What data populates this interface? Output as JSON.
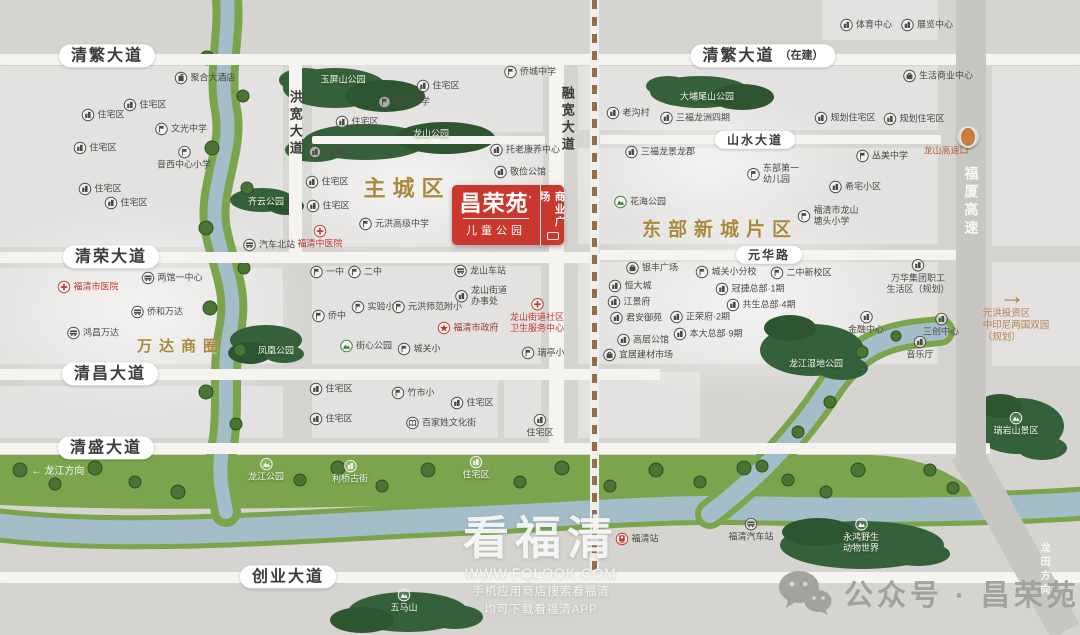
{
  "palette": {
    "bg": "#d5d4d1",
    "road": "#f5f4f1",
    "highway": "#c7c6c3",
    "water": "#a3bdc9",
    "bank": "#7ba44c",
    "park_dark": "#33603a",
    "gold": "#a8893e",
    "red": "#bf3a33",
    "logo_red": "#c9372f",
    "text": "#4b4a47",
    "brown": "#b5804e"
  },
  "logo": {
    "name": "昌荣苑",
    "mark": "’",
    "sub": "儿童公园",
    "side": "商业广场"
  },
  "watermark": {
    "title": "看福清",
    "url": "WWW.FQLOOK.COM",
    "line1": "手机应用商店搜索看福清",
    "line2": "均可下载看福清APP"
  },
  "wechat": {
    "text": "公众号 · 昌荣苑"
  },
  "map": {
    "blocks": [
      [
        0,
        66,
        283,
        181
      ],
      [
        0,
        268,
        283,
        96
      ],
      [
        0,
        386,
        283,
        52
      ],
      [
        312,
        62,
        231,
        70
      ],
      [
        312,
        144,
        231,
        103
      ],
      [
        312,
        266,
        229,
        98
      ],
      [
        312,
        374,
        186,
        64
      ],
      [
        504,
        374,
        37,
        64
      ],
      [
        578,
        66,
        360,
        64
      ],
      [
        578,
        148,
        360,
        96
      ],
      [
        578,
        262,
        360,
        102
      ],
      [
        578,
        372,
        122,
        66
      ],
      [
        822,
        0,
        116,
        40
      ],
      [
        992,
        66,
        88,
        180
      ],
      [
        992,
        262,
        88,
        104
      ]
    ],
    "glows": [
      [
        140,
        310,
        360,
        220
      ],
      [
        410,
        185,
        300,
        160
      ],
      [
        750,
        300,
        360,
        210
      ],
      [
        710,
        165,
        300,
        150
      ]
    ],
    "roads_h": [
      [
        0,
        54,
        1080,
        11
      ],
      [
        600,
        135,
        341,
        9
      ],
      [
        312,
        136,
        233,
        8
      ],
      [
        0,
        252,
        600,
        11
      ],
      [
        600,
        250,
        356,
        10
      ],
      [
        0,
        369,
        660,
        11
      ],
      [
        0,
        443,
        990,
        11
      ],
      [
        0,
        572,
        1080,
        11
      ]
    ],
    "roads_v": [
      [
        289,
        54,
        13,
        209
      ],
      [
        549,
        54,
        15,
        400
      ]
    ],
    "highway": {
      "v": [
        956,
        0,
        30,
        470
      ],
      "slant": {
        "x": 950,
        "y": 452,
        "w": 32,
        "h": 205,
        "rot": -29
      }
    },
    "dash": {
      "x": 590,
      "y": 0,
      "h": 575
    },
    "rivers": {
      "belt": "M0,455 L870,455 C908,456 938,466 962,482 L976,494 C930,503 880,501 820,498 C680,491 560,501 420,505 C280,509 130,511 0,505 Z",
      "left": "M226,-10 C232,30 218,70 226,110 C234,150 208,190 216,230 C224,270 238,290 230,330 C222,370 230,410 222,450 C218,475 222,490 226,512",
      "bottom": "M-12,524 C120,542 300,526 460,519 C580,514 650,507 735,508 C840,510 960,512 1092,503",
      "branch": "M710,514 C765,472 800,432 828,390 C850,357 872,341 906,335 C922,332 932,332 940,331"
    },
    "parks": [
      {
        "name": "yuping-park",
        "shapes": [
          [
            335,
            88,
            52,
            20
          ],
          [
            385,
            96,
            40,
            16
          ],
          [
            305,
            80,
            26,
            12
          ]
        ]
      },
      {
        "name": "longshan-park",
        "shapes": [
          [
            365,
            142,
            62,
            18
          ],
          [
            445,
            138,
            50,
            16
          ],
          [
            315,
            150,
            30,
            12
          ]
        ]
      },
      {
        "name": "pingshan-park",
        "shapes": [
          [
            700,
            92,
            50,
            16
          ],
          [
            742,
            97,
            32,
            13
          ],
          [
            668,
            86,
            22,
            10
          ]
        ]
      },
      {
        "name": "qiyun-park",
        "shapes": [
          [
            262,
            200,
            32,
            12
          ],
          [
            286,
            206,
            18,
            9
          ]
        ]
      },
      {
        "name": "fenghuang-park",
        "shapes": [
          [
            266,
            340,
            36,
            15
          ],
          [
            250,
            353,
            22,
            11
          ],
          [
            284,
            354,
            20,
            9
          ]
        ]
      },
      {
        "name": "wetland-park",
        "shapes": [
          [
            812,
            350,
            52,
            26
          ],
          [
            790,
            328,
            26,
            13
          ],
          [
            842,
            368,
            26,
            12
          ]
        ]
      },
      {
        "name": "ruiyan-scenic",
        "shapes": [
          [
            1018,
            426,
            46,
            28
          ],
          [
            1000,
            406,
            22,
            12
          ],
          [
            1042,
            448,
            25,
            12
          ]
        ]
      },
      {
        "name": "yonghong-zoo",
        "shapes": [
          [
            862,
            545,
            82,
            24
          ],
          [
            818,
            532,
            36,
            14
          ],
          [
            918,
            554,
            32,
            12
          ]
        ]
      },
      {
        "name": "wuma-hill",
        "shapes": [
          [
            408,
            612,
            60,
            20
          ],
          [
            362,
            620,
            32,
            13
          ],
          [
            455,
            617,
            28,
            12
          ]
        ]
      }
    ],
    "trees": [
      [
        207,
        58,
        7
      ],
      [
        243,
        96,
        6
      ],
      [
        212,
        148,
        7
      ],
      [
        247,
        188,
        6
      ],
      [
        206,
        228,
        7
      ],
      [
        244,
        268,
        6
      ],
      [
        210,
        308,
        7
      ],
      [
        240,
        350,
        6
      ],
      [
        206,
        392,
        7
      ],
      [
        236,
        424,
        6
      ],
      [
        20,
        470,
        7
      ],
      [
        55,
        484,
        6
      ],
      [
        95,
        468,
        7
      ],
      [
        135,
        482,
        6
      ],
      [
        178,
        492,
        7
      ],
      [
        300,
        480,
        6
      ],
      [
        338,
        468,
        7
      ],
      [
        382,
        486,
        6
      ],
      [
        428,
        470,
        7
      ],
      [
        520,
        482,
        6
      ],
      [
        562,
        468,
        7
      ],
      [
        610,
        486,
        6
      ],
      [
        656,
        470,
        7
      ],
      [
        700,
        482,
        6
      ],
      [
        744,
        468,
        7
      ],
      [
        788,
        480,
        6
      ],
      [
        826,
        492,
        6
      ],
      [
        858,
        470,
        7
      ],
      [
        762,
        466,
        6
      ],
      [
        798,
        432,
        6
      ],
      [
        830,
        402,
        6
      ],
      [
        862,
        352,
        6
      ],
      [
        896,
        336,
        5
      ],
      [
        930,
        470,
        6
      ],
      [
        953,
        488,
        6
      ]
    ],
    "labels": [
      {
        "x": 107,
        "y": 56,
        "t": "清繁大道",
        "s": "pill"
      },
      {
        "x": 763,
        "y": 56,
        "t": "清繁大道",
        "sfx": "（在建）",
        "s": "pill"
      },
      {
        "x": 755,
        "y": 140,
        "t": "山水大道",
        "s": "pill",
        "fs": 12
      },
      {
        "x": 111,
        "y": 257,
        "t": "清荣大道",
        "s": "pill"
      },
      {
        "x": 769,
        "y": 255,
        "t": "元华路",
        "s": "pill",
        "fs": 12
      },
      {
        "x": 110,
        "y": 374,
        "t": "清昌大道",
        "s": "pill"
      },
      {
        "x": 106,
        "y": 448,
        "t": "清盛大道",
        "s": "pill"
      },
      {
        "x": 288,
        "y": 577,
        "t": "创业大道",
        "s": "pill"
      },
      {
        "x": 295,
        "y": 124,
        "t": "洪宽大道",
        "s": "v",
        "fs": 13
      },
      {
        "x": 567,
        "y": 120,
        "t": "融宽大道",
        "s": "v",
        "fs": 13
      },
      {
        "x": 971,
        "y": 202,
        "t": "福厦高速",
        "s": "v",
        "fs": 14,
        "c": "#f7f6f3"
      },
      {
        "x": 1043,
        "y": 570,
        "t": "龙田方向",
        "s": "v",
        "fs": 10,
        "c": "#f7f6f3"
      },
      {
        "x": 407,
        "y": 189,
        "t": "主城区",
        "s": "gold",
        "fs": 22
      },
      {
        "x": 720,
        "y": 231,
        "t": "东部新城片区",
        "s": "gold",
        "fs": 19
      },
      {
        "x": 181,
        "y": 347,
        "t": "万达商圈",
        "s": "gold",
        "fs": 15
      },
      {
        "x": 58,
        "y": 472,
        "t": "← 龙江方向",
        "s": "txt",
        "fs": 10,
        "c": "#f7f6f3"
      },
      {
        "x": 343,
        "y": 80,
        "t": "玉屏山公园",
        "s": "park"
      },
      {
        "x": 431,
        "y": 134,
        "t": "龙山公园",
        "s": "park"
      },
      {
        "x": 707,
        "y": 97,
        "t": "大埔尾山公园",
        "s": "park"
      },
      {
        "x": 266,
        "y": 202,
        "t": "齐云公园",
        "s": "park"
      },
      {
        "x": 276,
        "y": 351,
        "t": "凤凰公园",
        "s": "park"
      },
      {
        "x": 816,
        "y": 364,
        "t": "龙江湿地公园",
        "s": "park"
      },
      {
        "x": 1016,
        "y": 424,
        "t": "瑞岩山景区",
        "s": "pst",
        "i": "park"
      },
      {
        "x": 266,
        "y": 470,
        "t": "龙江公园",
        "s": "pst",
        "i": "park"
      },
      {
        "x": 350,
        "y": 472,
        "t": "利桥古街",
        "s": "pst",
        "i": "bld"
      },
      {
        "x": 476,
        "y": 468,
        "t": "住宅区",
        "s": "pst",
        "i": "bld"
      },
      {
        "x": 404,
        "y": 601,
        "t": "五马山",
        "s": "pst",
        "i": "park"
      },
      {
        "x": 861,
        "y": 536,
        "t": "永鸿野生动物世界",
        "s": "pst",
        "i": "park",
        "lines": [
          "永鸿野生",
          "动物世界"
        ]
      },
      {
        "x": 205,
        "y": 78,
        "t": "聚合大酒店",
        "i": "hotel"
      },
      {
        "x": 145,
        "y": 105,
        "t": "住宅区",
        "i": "bld"
      },
      {
        "x": 103,
        "y": 115,
        "t": "住宅区",
        "i": "bld"
      },
      {
        "x": 181,
        "y": 129,
        "t": "文光中学",
        "i": "sch"
      },
      {
        "x": 95,
        "y": 148,
        "t": "住宅区",
        "i": "bld"
      },
      {
        "x": 184,
        "y": 158,
        "t": "音西中心小学",
        "i": "sch",
        "s": "st"
      },
      {
        "x": 100,
        "y": 189,
        "t": "住宅区",
        "i": "bld"
      },
      {
        "x": 126,
        "y": 203,
        "t": "住宅区",
        "i": "bld"
      },
      {
        "x": 269,
        "y": 245,
        "t": "汽车北站",
        "i": "bus"
      },
      {
        "x": 88,
        "y": 287,
        "t": "福清市医院",
        "i": "hosp",
        "c": "#bf3a33"
      },
      {
        "x": 172,
        "y": 278,
        "t": "两馆一中心",
        "i": "bus"
      },
      {
        "x": 157,
        "y": 312,
        "t": "侨和万达",
        "i": "bus"
      },
      {
        "x": 93,
        "y": 333,
        "t": "鸿昌万达",
        "i": "bus"
      },
      {
        "x": 438,
        "y": 86,
        "t": "住宅区",
        "i": "bld"
      },
      {
        "x": 404,
        "y": 102,
        "t": "玉屏小学",
        "i": "sch"
      },
      {
        "x": 357,
        "y": 122,
        "t": "住宅区",
        "i": "bld"
      },
      {
        "x": 330,
        "y": 152,
        "t": "住宅区",
        "i": "bld"
      },
      {
        "x": 327,
        "y": 182,
        "t": "住宅区",
        "i": "bld"
      },
      {
        "x": 328,
        "y": 206,
        "t": "住宅区",
        "i": "bld"
      },
      {
        "x": 394,
        "y": 224,
        "t": "元洪高级中学",
        "i": "sch"
      },
      {
        "x": 320,
        "y": 237,
        "t": "福清中医院",
        "i": "hosp",
        "s": "st",
        "c": "#bf3a33"
      },
      {
        "x": 530,
        "y": 72,
        "t": "侨城中学",
        "i": "sch"
      },
      {
        "x": 525,
        "y": 150,
        "t": "托老康养中心",
        "i": "bld"
      },
      {
        "x": 520,
        "y": 172,
        "t": "敬俭公馆",
        "i": "bld"
      },
      {
        "x": 866,
        "y": 25,
        "t": "体育中心",
        "i": "bld"
      },
      {
        "x": 927,
        "y": 25,
        "t": "展览中心",
        "i": "bld"
      },
      {
        "x": 938,
        "y": 76,
        "t": "生活商业中心",
        "i": "shop"
      },
      {
        "x": 628,
        "y": 113,
        "t": "老沟村",
        "i": "bld"
      },
      {
        "x": 695,
        "y": 118,
        "t": "三福龙洲四期",
        "i": "bld"
      },
      {
        "x": 845,
        "y": 118,
        "t": "规划住宅区",
        "i": "bld"
      },
      {
        "x": 914,
        "y": 119,
        "t": "规划住宅区",
        "i": "bld"
      },
      {
        "x": 660,
        "y": 152,
        "t": "三福龙景龙郡",
        "i": "bld"
      },
      {
        "x": 882,
        "y": 156,
        "t": "丛美中学",
        "i": "sch"
      },
      {
        "x": 773,
        "y": 174,
        "t": "东部第一幼儿园",
        "i": "sch",
        "lines": [
          "东部第一",
          "幼儿园"
        ]
      },
      {
        "x": 855,
        "y": 187,
        "t": "希宅小区",
        "i": "bld"
      },
      {
        "x": 640,
        "y": 202,
        "t": "花海公园",
        "i": "park",
        "ic": "#3f7d3a"
      },
      {
        "x": 828,
        "y": 216,
        "t": "福清市龙山塘头小学",
        "i": "sch",
        "lines": [
          "福清市龙山",
          "塘头小学"
        ]
      },
      {
        "x": 946,
        "y": 151,
        "t": "龙山高速口",
        "s": "txt",
        "fs": 9,
        "c": "#b0623a"
      },
      {
        "x": 968,
        "y": 137,
        "t": "",
        "s": "dot"
      },
      {
        "x": 327,
        "y": 272,
        "t": "一中",
        "i": "sch"
      },
      {
        "x": 365,
        "y": 272,
        "t": "二中",
        "i": "sch"
      },
      {
        "x": 480,
        "y": 271,
        "t": "龙山车站",
        "i": "bus"
      },
      {
        "x": 373,
        "y": 307,
        "t": "实验小",
        "i": "sch"
      },
      {
        "x": 427,
        "y": 307,
        "t": "元洪师范附小",
        "i": "sch"
      },
      {
        "x": 329,
        "y": 316,
        "t": "侨中",
        "i": "sch"
      },
      {
        "x": 481,
        "y": 296,
        "t": "龙山街道办事处",
        "i": "bld",
        "lines": [
          "龙山街道",
          "办事处"
        ]
      },
      {
        "x": 468,
        "y": 328,
        "t": "福清市政府",
        "i": "star",
        "ic": "#c0392b",
        "c": "#9c3a30"
      },
      {
        "x": 366,
        "y": 346,
        "t": "街心公园",
        "i": "park",
        "ic": "#3f7d3a"
      },
      {
        "x": 419,
        "y": 349,
        "t": "城关小",
        "i": "sch"
      },
      {
        "x": 537,
        "y": 316,
        "t": "龙山街道社区卫生服务中心",
        "i": "hosp",
        "s": "st",
        "lines": [
          "龙山街道社区",
          "卫生服务中心"
        ],
        "c": "#bf3a33"
      },
      {
        "x": 543,
        "y": 353,
        "t": "瑞亭小",
        "i": "sch"
      },
      {
        "x": 652,
        "y": 268,
        "t": "银丰广场",
        "i": "shop"
      },
      {
        "x": 726,
        "y": 272,
        "t": "城关小分校",
        "i": "sch"
      },
      {
        "x": 801,
        "y": 273,
        "t": "二中新校区",
        "i": "sch"
      },
      {
        "x": 630,
        "y": 286,
        "t": "恒大城",
        "i": "bld"
      },
      {
        "x": 750,
        "y": 289,
        "t": "冠捷总部·1期",
        "i": "bld"
      },
      {
        "x": 629,
        "y": 302,
        "t": "江景府",
        "i": "bld"
      },
      {
        "x": 761,
        "y": 305,
        "t": "共生总部·4期",
        "i": "bld"
      },
      {
        "x": 636,
        "y": 318,
        "t": "君安御苑",
        "i": "bld"
      },
      {
        "x": 700,
        "y": 317,
        "t": "正荣府·2期",
        "i": "bld"
      },
      {
        "x": 708,
        "y": 334,
        "t": "本大总部·9期",
        "i": "bld"
      },
      {
        "x": 643,
        "y": 340,
        "t": "高层公馆",
        "i": "bld"
      },
      {
        "x": 638,
        "y": 355,
        "t": "宜居建材市场",
        "i": "shop"
      },
      {
        "x": 866,
        "y": 323,
        "t": "金融中心",
        "i": "bld",
        "s": "st"
      },
      {
        "x": 941,
        "y": 325,
        "t": "三创中心",
        "i": "bld",
        "s": "st"
      },
      {
        "x": 920,
        "y": 348,
        "t": "音乐厅",
        "i": "bld",
        "s": "st"
      },
      {
        "x": 918,
        "y": 277,
        "t": "万华集团职工生活区（规划）",
        "i": "bld",
        "s": "st",
        "lines": [
          "万华集团职工",
          "生活区（规划）"
        ]
      },
      {
        "x": 1012,
        "y": 296,
        "t": "→",
        "s": "txt",
        "fs": 26,
        "c": "#b5804e"
      },
      {
        "x": 1016,
        "y": 326,
        "t": "元洪投资区 中印尼两国双园（规划）",
        "s": "txt3",
        "fs": 9.5,
        "c": "#b5804e",
        "lines": [
          "元洪投资区",
          "中印尼两国双园",
          "（规划）"
        ]
      },
      {
        "x": 331,
        "y": 389,
        "t": "住宅区",
        "i": "bld"
      },
      {
        "x": 413,
        "y": 393,
        "t": "竹市小",
        "i": "sch"
      },
      {
        "x": 472,
        "y": 403,
        "t": "住宅区",
        "i": "bld"
      },
      {
        "x": 331,
        "y": 419,
        "t": "住宅区",
        "i": "bld"
      },
      {
        "x": 441,
        "y": 423,
        "t": "百家姓文化街",
        "i": "cult"
      },
      {
        "x": 540,
        "y": 426,
        "t": "住宅区",
        "i": "bld",
        "s": "st"
      },
      {
        "x": 637,
        "y": 539,
        "t": "福清站",
        "i": "train",
        "ic": "#c0392b"
      },
      {
        "x": 751,
        "y": 530,
        "t": "福清汽车站",
        "i": "bus",
        "s": "st"
      }
    ]
  }
}
